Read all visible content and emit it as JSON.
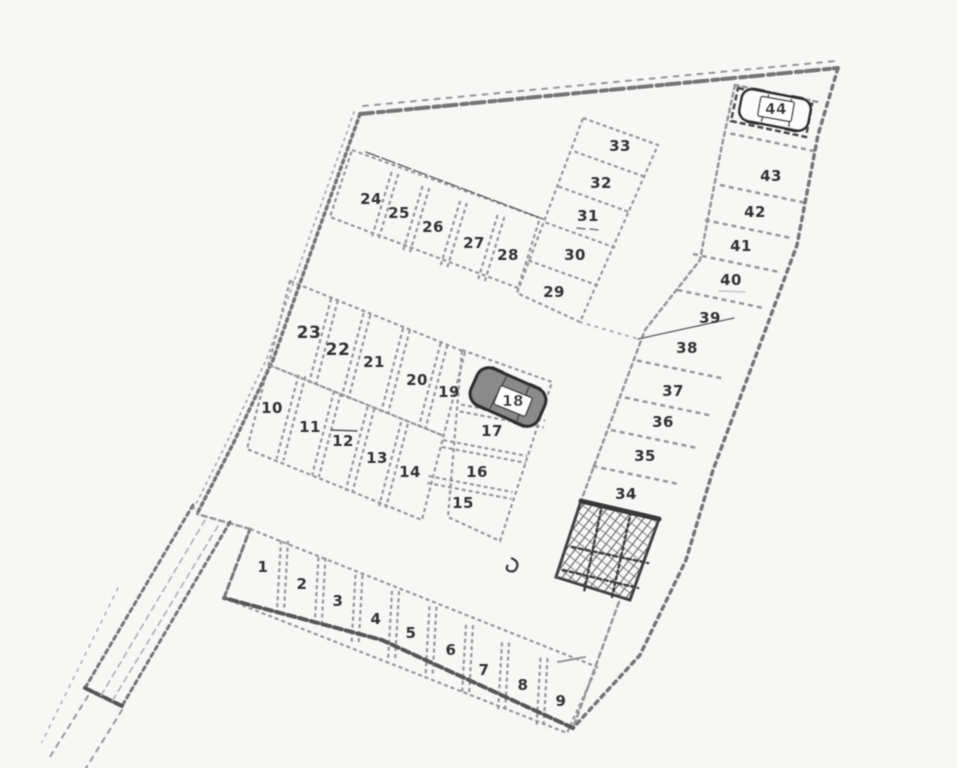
{
  "plan": {
    "background": "#f7f7f6",
    "palette": {
      "faint": "#ababab",
      "light": "#969696",
      "mid": "#757575",
      "dark": "#4a4a4a",
      "ink": "#333333",
      "paper": "#f7f7f6",
      "car_light_fill": "#fbfbfb",
      "car_dark_fill": "#8a8a8a",
      "car_stroke": "#2e2e2e",
      "plate_fill": "#ffffff",
      "plate_stroke": "#333333"
    },
    "stalls": [
      {
        "n": "1",
        "x": 263,
        "y": 567
      },
      {
        "n": "2",
        "x": 302,
        "y": 584
      },
      {
        "n": "3",
        "x": 338,
        "y": 601
      },
      {
        "n": "4",
        "x": 376,
        "y": 619
      },
      {
        "n": "5",
        "x": 411,
        "y": 633
      },
      {
        "n": "6",
        "x": 451,
        "y": 650
      },
      {
        "n": "7",
        "x": 484,
        "y": 670
      },
      {
        "n": "8",
        "x": 523,
        "y": 685
      },
      {
        "n": "9",
        "x": 561,
        "y": 701
      },
      {
        "n": "10",
        "x": 272,
        "y": 408
      },
      {
        "n": "11",
        "x": 310,
        "y": 427
      },
      {
        "n": "12",
        "x": 343,
        "y": 441
      },
      {
        "n": "13",
        "x": 377,
        "y": 458
      },
      {
        "n": "14",
        "x": 410,
        "y": 472
      },
      {
        "n": "15",
        "x": 463,
        "y": 503
      },
      {
        "n": "16",
        "x": 477,
        "y": 472
      },
      {
        "n": "17",
        "x": 492,
        "y": 431
      },
      {
        "n": "18",
        "x": 513,
        "y": 401,
        "plate": true,
        "rot": 22
      },
      {
        "n": "19",
        "x": 449,
        "y": 392
      },
      {
        "n": "20",
        "x": 417,
        "y": 380
      },
      {
        "n": "21",
        "x": 374,
        "y": 362
      },
      {
        "n": "22",
        "x": 338,
        "y": 350,
        "s": 17
      },
      {
        "n": "23",
        "x": 309,
        "y": 333,
        "s": 17
      },
      {
        "n": "24",
        "x": 371,
        "y": 199
      },
      {
        "n": "25",
        "x": 399,
        "y": 213
      },
      {
        "n": "26",
        "x": 433,
        "y": 227
      },
      {
        "n": "27",
        "x": 474,
        "y": 243
      },
      {
        "n": "28",
        "x": 508,
        "y": 255
      },
      {
        "n": "29",
        "x": 554,
        "y": 292
      },
      {
        "n": "30",
        "x": 575,
        "y": 255
      },
      {
        "n": "31",
        "x": 588,
        "y": 216
      },
      {
        "n": "32",
        "x": 601,
        "y": 183
      },
      {
        "n": "33",
        "x": 620,
        "y": 146
      },
      {
        "n": "34",
        "x": 626,
        "y": 494
      },
      {
        "n": "35",
        "x": 645,
        "y": 456
      },
      {
        "n": "36",
        "x": 663,
        "y": 422
      },
      {
        "n": "37",
        "x": 673,
        "y": 391
      },
      {
        "n": "38",
        "x": 687,
        "y": 348
      },
      {
        "n": "39",
        "x": 710,
        "y": 318
      },
      {
        "n": "40",
        "x": 731,
        "y": 280
      },
      {
        "n": "41",
        "x": 741,
        "y": 246
      },
      {
        "n": "42",
        "x": 755,
        "y": 212
      },
      {
        "n": "43",
        "x": 771,
        "y": 176
      },
      {
        "n": "44",
        "x": 776,
        "y": 109,
        "plate": true,
        "rot": 10
      }
    ],
    "polygons": [
      {
        "name": "stall-row-24-28-outline",
        "pts": [
          [
            352,
            150
          ],
          [
            540,
            218
          ],
          [
            518,
            288
          ],
          [
            330,
            217
          ]
        ]
      },
      {
        "name": "stall-col-29-33-outline",
        "pts": [
          [
            583,
            118
          ],
          [
            658,
            145
          ],
          [
            580,
            322
          ],
          [
            517,
            293
          ]
        ]
      },
      {
        "name": "stall-block-a-outline",
        "pts": [
          [
            290,
            281
          ],
          [
            465,
            352
          ],
          [
            422,
            520
          ],
          [
            247,
            449
          ]
        ]
      },
      {
        "name": "stall-block-b-outline",
        "pts": [
          [
            462,
            350
          ],
          [
            552,
            382
          ],
          [
            500,
            541
          ],
          [
            448,
            517
          ]
        ]
      },
      {
        "name": "stall-row-1-9-outline",
        "pts": [
          [
            250,
            529
          ],
          [
            597,
            667
          ],
          [
            567,
            733
          ],
          [
            224,
            598
          ]
        ]
      },
      {
        "name": "stall-44-box",
        "pts": [
          [
            738,
            88
          ],
          [
            812,
            104
          ],
          [
            806,
            137
          ],
          [
            731,
            121
          ]
        ],
        "w": 2.5,
        "dash": "6 3",
        "color": "dark"
      },
      {
        "name": "building-hatch",
        "pts": [
          [
            581,
            501
          ],
          [
            659,
            519
          ],
          [
            630,
            600
          ],
          [
            556,
            577
          ]
        ],
        "fill": "hatch",
        "w": 3,
        "dash": "",
        "color": "#3f3f3f"
      }
    ],
    "divider_bands": [
      {
        "name": "row-1-9",
        "seq": [
          "1",
          "2",
          "3",
          "4",
          "5",
          "6",
          "7",
          "8",
          "9"
        ],
        "hv": [
          -2,
          35
        ],
        "dbl": true
      },
      {
        "name": "block-a-top",
        "seq": [
          "23",
          "22",
          "21",
          "20",
          "19"
        ],
        "hv": [
          -11,
          42
        ],
        "dbl": true
      },
      {
        "name": "block-a-bottom",
        "seq": [
          "10",
          "11",
          "12",
          "13",
          "14"
        ],
        "hv": [
          -11,
          42
        ],
        "dbl": true
      },
      {
        "name": "block-b",
        "seq": [
          "18",
          "17",
          "16",
          "15"
        ],
        "hv": [
          42,
          8
        ],
        "dbl": true
      },
      {
        "name": "row-24-28",
        "seq": [
          "24",
          "25",
          "26",
          "27",
          "28"
        ],
        "hv": [
          -10,
          33
        ],
        "dbl": true
      },
      {
        "name": "col-29-33",
        "seq": [
          "33",
          "32",
          "31",
          "30",
          "29"
        ],
        "hv": [
          36,
          13
        ],
        "dbl": false
      },
      {
        "name": "col-34-44",
        "seq": [
          "44",
          "43",
          "42",
          "41",
          "40",
          "39",
          "38",
          "37",
          "36",
          "35",
          "34"
        ],
        "hv": [
          43,
          9
        ],
        "dbl": false,
        "skip": [
          5
        ],
        "w": 2.5,
        "dash": "5 4"
      }
    ],
    "polylines": [
      {
        "name": "top-boundary",
        "pts": [
          [
            360,
            114
          ],
          [
            838,
            68
          ]
        ],
        "w": 4,
        "dash": "13 5 6 4",
        "color": "mid"
      },
      {
        "name": "top-boundary-double",
        "pts": [
          [
            363,
            106
          ],
          [
            836,
            61
          ]
        ],
        "w": 2,
        "dash": "5 7",
        "color": "light"
      },
      {
        "name": "right-boundary",
        "pts": [
          [
            838,
            68
          ],
          [
            818,
            135
          ],
          [
            797,
            245
          ],
          [
            758,
            350
          ],
          [
            713,
            470
          ],
          [
            686,
            560
          ],
          [
            640,
            655
          ],
          [
            573,
            728
          ]
        ],
        "w": 3.5,
        "dash": "4 5",
        "color": "mid"
      },
      {
        "name": "bottom-boundary",
        "pts": [
          [
            573,
            728
          ],
          [
            382,
            640
          ],
          [
            224,
            598
          ]
        ],
        "w": 4,
        "dash": "8 4",
        "color": "#565656"
      },
      {
        "name": "row-1-9-left-cap",
        "pts": [
          [
            224,
            598
          ],
          [
            250,
            529
          ]
        ],
        "w": 3,
        "dash": "6 4",
        "color": "mid"
      },
      {
        "name": "boundary-jog",
        "pts": [
          [
            250,
            529
          ],
          [
            197,
            514
          ]
        ],
        "w": 2.5,
        "dash": "5 4",
        "color": "light"
      },
      {
        "name": "left-boundary",
        "pts": [
          [
            360,
            114
          ],
          [
            318,
            232
          ],
          [
            273,
            360
          ],
          [
            233,
            444
          ],
          [
            197,
            514
          ]
        ],
        "w": 3.5,
        "dash": "3 4",
        "color": "mid"
      },
      {
        "name": "left-boundary-double",
        "pts": [
          [
            354,
            112
          ],
          [
            312,
            230
          ],
          [
            267,
            358
          ],
          [
            227,
            442
          ],
          [
            192,
            512
          ]
        ],
        "w": 1.8,
        "dash": "2 5",
        "color": "faint"
      },
      {
        "name": "block-a-midline",
        "pts": [
          [
            269,
            365
          ],
          [
            444,
            436
          ]
        ],
        "w": 2.2,
        "dash": "4 3",
        "color": "light"
      },
      {
        "name": "col-34-44-left-edge",
        "pts": [
          [
            735,
            85
          ],
          [
            722,
            145
          ],
          [
            700,
            260
          ],
          [
            645,
            330
          ],
          [
            581,
            501
          ]
        ],
        "w": 2.5,
        "dash": "4 4",
        "color": "light"
      },
      {
        "name": "col-34-44-top-edge",
        "pts": [
          [
            735,
            85
          ],
          [
            818,
            102
          ]
        ],
        "w": 2.5,
        "dash": "4 4",
        "color": "light"
      },
      {
        "name": "survey-line",
        "pts": [
          [
            366,
            152
          ],
          [
            543,
            219
          ]
        ],
        "w": 1.3,
        "dash": "14 3",
        "color": "#5a5a5a"
      },
      {
        "name": "divider-39-38-thin",
        "pts": [
          [
            638,
            339
          ],
          [
            734,
            318
          ]
        ],
        "w": 1.3,
        "dash": "",
        "color": "#5a5a5a"
      },
      {
        "name": "aisle-dots",
        "pts": [
          [
            580,
            322
          ],
          [
            638,
            339
          ]
        ],
        "w": 2,
        "dash": "2 6",
        "color": "faint"
      },
      {
        "name": "building-top-bar",
        "pts": [
          [
            581,
            501
          ],
          [
            659,
            519
          ]
        ],
        "w": 5,
        "dash": "",
        "color": "#383838"
      },
      {
        "name": "building-tail-line",
        "pts": [
          [
            619,
            602
          ],
          [
            573,
            728
          ]
        ],
        "w": 2.5,
        "dash": "5 4",
        "color": "light"
      },
      {
        "name": "tail-tick",
        "pts": [
          [
            558,
            662
          ],
          [
            585,
            657
          ]
        ],
        "w": 2,
        "dash": "",
        "color": "light"
      },
      {
        "name": "building-inner-1",
        "pts": [
          [
            572,
            547
          ],
          [
            648,
            563
          ]
        ],
        "w": 2.5,
        "dash": "4 3",
        "color": "#3d3d3d"
      },
      {
        "name": "building-inner-2",
        "pts": [
          [
            563,
            570
          ],
          [
            638,
            588
          ]
        ],
        "w": 2.5,
        "dash": "4 3",
        "color": "#3d3d3d"
      },
      {
        "name": "building-inner-3",
        "pts": [
          [
            602,
            505
          ],
          [
            584,
            592
          ]
        ],
        "w": 2.5,
        "dash": "3 3",
        "color": "#3d3d3d"
      },
      {
        "name": "building-inner-4",
        "pts": [
          [
            631,
            512
          ],
          [
            612,
            597
          ]
        ],
        "w": 2.5,
        "dash": "3 3",
        "color": "#3d3d3d"
      },
      {
        "name": "driveway-nw-edge",
        "pts": [
          [
            193,
            505
          ],
          [
            85,
            688
          ]
        ],
        "w": 3,
        "dash": "4 4",
        "color": "mid"
      },
      {
        "name": "driveway-se-edge",
        "pts": [
          [
            230,
            522
          ],
          [
            122,
            706
          ]
        ],
        "w": 3,
        "dash": "4 4",
        "color": "mid"
      },
      {
        "name": "driveway-end-cap",
        "pts": [
          [
            85,
            688
          ],
          [
            122,
            706
          ]
        ],
        "w": 4,
        "dash": "8 3",
        "color": "#555555"
      },
      {
        "name": "driveway-inner-1",
        "pts": [
          [
            205,
            520
          ],
          [
            99,
            699
          ]
        ],
        "w": 1.5,
        "dash": "6 5",
        "color": "faint"
      },
      {
        "name": "driveway-inner-2",
        "pts": [
          [
            218,
            526
          ],
          [
            111,
            703
          ]
        ],
        "w": 1.5,
        "dash": "6 5",
        "color": "faint"
      },
      {
        "name": "driveway-outer-faint",
        "pts": [
          [
            118,
            588
          ],
          [
            42,
            742
          ]
        ],
        "w": 1.5,
        "dash": "3 6",
        "color": "faint"
      },
      {
        "name": "driveway-ext-1",
        "pts": [
          [
            88,
            696
          ],
          [
            48,
            760
          ]
        ],
        "w": 2,
        "dash": "5 6",
        "color": "light"
      },
      {
        "name": "driveway-ext-2",
        "pts": [
          [
            122,
            710
          ],
          [
            86,
            768
          ]
        ],
        "w": 2,
        "dash": "5 6",
        "color": "light"
      },
      {
        "name": "overline-12",
        "pts": [
          [
            331,
            430
          ],
          [
            357,
            431
          ]
        ],
        "w": 1.5,
        "dash": "",
        "color": "#555555"
      },
      {
        "name": "underdash-31-a",
        "pts": [
          [
            577,
            228
          ],
          [
            585,
            229
          ]
        ],
        "w": 1.5,
        "dash": "",
        "color": "#777777"
      },
      {
        "name": "underdash-31-b",
        "pts": [
          [
            590,
            229
          ],
          [
            598,
            230
          ]
        ],
        "w": 1.5,
        "dash": "",
        "color": "#777777"
      },
      {
        "name": "underline-40",
        "pts": [
          [
            719,
            291
          ],
          [
            745,
            292
          ]
        ],
        "w": 1.2,
        "dash": "",
        "color": "#bbbbbb"
      }
    ],
    "cars": [
      {
        "id": "44",
        "cx": 775,
        "cy": 110,
        "angle": 11,
        "w": 70,
        "h": 32,
        "shade": "light"
      },
      {
        "id": "18",
        "cx": 508,
        "cy": 397,
        "angle": 24,
        "w": 74,
        "h": 40,
        "shade": "dark"
      }
    ],
    "scribble_path": "M511,558 q8,3 6,9 q-2,6 -8,4 q-4,-2 -1,-6",
    "label_style": {
      "size": 15,
      "color": "#333333",
      "plate_w": 34,
      "plate_h": 20
    }
  }
}
